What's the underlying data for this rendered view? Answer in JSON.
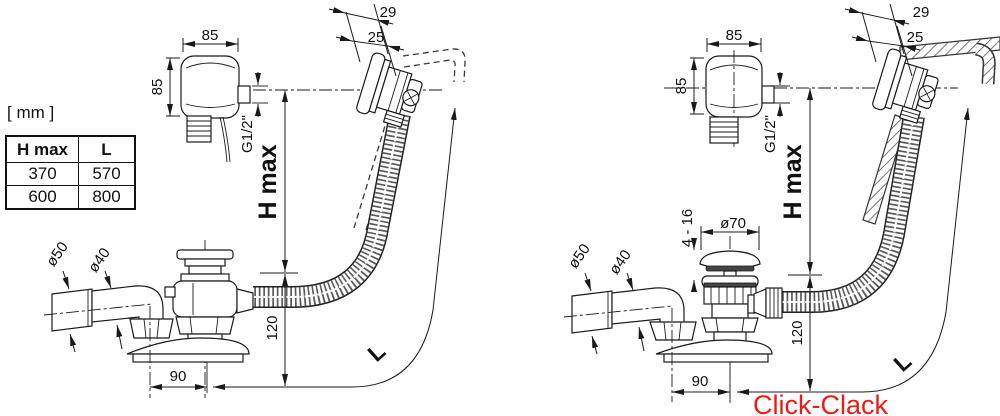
{
  "units_label": "[ mm ]",
  "table": {
    "headers": [
      "H max",
      "L"
    ],
    "rows": [
      [
        "370",
        "570"
      ],
      [
        "600",
        "800"
      ]
    ]
  },
  "caption": {
    "text": "Click-Clack",
    "color": "#ed1c16"
  },
  "left": {
    "width_85": "85",
    "height_85": "85",
    "depth_29": "29",
    "depth_25": "25",
    "thread": "G1/2\"",
    "h_max": "H max",
    "dia_50": "ø50",
    "dia_40": "ø40",
    "height_120": "120",
    "offset_90": "90",
    "length_l": "L"
  },
  "right": {
    "width_85": "85",
    "height_85": "85",
    "depth_29": "29",
    "depth_25": "25",
    "thread": "G1/2\"",
    "h_max": "H max",
    "dia_50": "ø50",
    "dia_40": "ø40",
    "height_120": "120",
    "offset_90": "90",
    "length_l": "L",
    "dia_70": "ø70",
    "clamp_range": "4 - 16"
  }
}
